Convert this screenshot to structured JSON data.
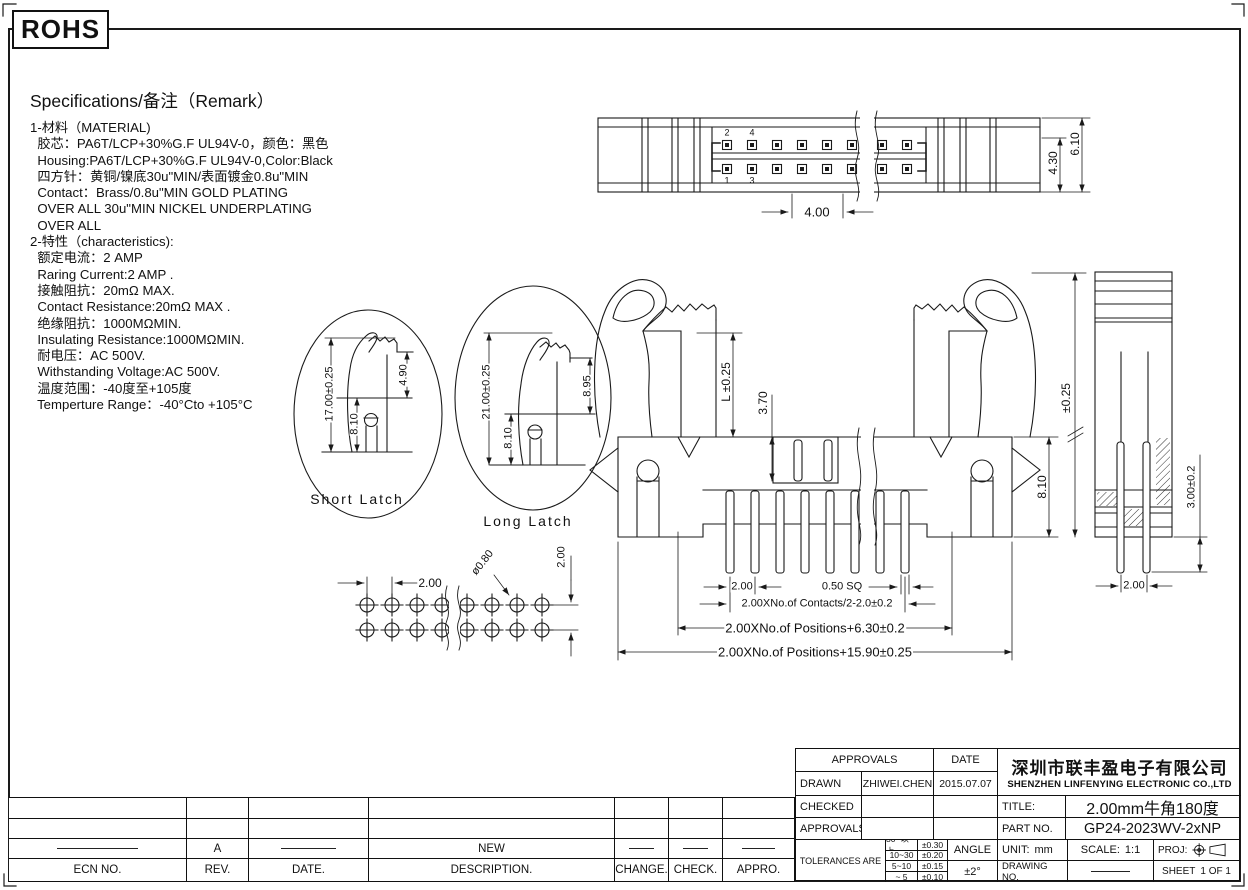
{
  "rohs_label": "ROHS",
  "specifications": {
    "title": "Specifications/备注（Remark）",
    "lines": [
      "1-材料（MATERIAL)",
      "  胶芯：PA6T/LCP+30%G.F UL94V-0，颜色：黑色",
      "  Housing:PA6T/LCP+30%G.F UL94V-0,Color:Black",
      "  四方针：黄铜/镍底30u\"MIN/表面镀金0.8u\"MIN",
      "  Contact：Brass/0.8u\"MIN GOLD PLATING",
      "  OVER ALL 30u\"MIN NICKEL UNDERPLATING",
      "  OVER ALL",
      "2-特性（characteristics):",
      "  额定电流：2 AMP",
      "  Raring Current:2 AMP .",
      "  接触阻抗：20mΩ MAX.",
      "  Contact Resistance:20mΩ MAX .",
      "  绝缘阻抗：1000MΩMIN.",
      "  Insulating Resistance:1000MΩMIN.",
      "  耐电压：AC 500V.",
      "  Withstanding Voltage:AC 500V.",
      "  温度范围：-40度至+105度",
      "  Temperture Range：-40°Cto +105°C"
    ]
  },
  "views": {
    "short_latch_label": "Short Latch",
    "long_latch_label": "Long Latch"
  },
  "pin_labels": {
    "p2": "2",
    "p4": "4",
    "p1": "1",
    "p3": "3"
  },
  "dimensions": {
    "top_view": {
      "notch": "4.00",
      "inner": "4.30",
      "overall": "6.10"
    },
    "front_view": {
      "latch_height": "L ±0.25",
      "slot_depth": "3.70",
      "body_height": "8.10",
      "pin_pitch": "2.00",
      "pin_square": "0.50 SQ",
      "contacts_span": "2.00XNo.of Contacts/2-2.0±0.2",
      "positions_span": "2.00XNo.of Positions+6.30±0.2",
      "overall_span": "2.00XNo.of Positions+15.90±0.25"
    },
    "side_view": {
      "height_tol": "±0.25",
      "tail_length": "3.00±0.2",
      "pin_pitch": "2.00"
    },
    "short_latch": {
      "overall": "17.00±0.25",
      "body": "8.10",
      "tip": "4.90"
    },
    "long_latch": {
      "overall": "21.00±0.25",
      "body": "8.10",
      "tip": "8.95"
    },
    "footprint": {
      "pitch": "2.00",
      "hole_dia": "ø0.80",
      "row_pitch": "2.00"
    }
  },
  "title_block": {
    "approvals_header": "APPROVALS",
    "date_header": "DATE",
    "rows": [
      {
        "label": "DRAWN",
        "name": "ZHIWEI.CHEN",
        "date": "2015.07.07"
      },
      {
        "label": "CHECKED",
        "name": "",
        "date": ""
      },
      {
        "label": "APPROVALS",
        "name": "",
        "date": ""
      }
    ],
    "tolerances_label": "TOLERANCES ARE",
    "tolerance_ranges": [
      "30~以上",
      "10~30",
      "5~10",
      "~ 5"
    ],
    "tolerance_values": [
      "±0.30",
      "±0.20",
      "±0.15",
      "±0.10"
    ],
    "angle_label": "ANGLE",
    "angle_value": "±2°",
    "company_cn": "深圳市联丰盈电子有限公司",
    "company_en": "SHENZHEN LINFENYING ELECTRONIC CO.,LTD",
    "title_label": "TITLE:",
    "title_value": "2.00mm牛角180度",
    "part_label": "PART NO.",
    "part_value": "GP24-2023WV-2xNP",
    "unit_label": "UNIT:",
    "unit_value": "mm",
    "scale_label": "SCALE:",
    "scale_value": "1:1",
    "proj_label": "PROJ:",
    "drawing_no_label": "DRAWING NO.",
    "sheet_label": "SHEET",
    "sheet_value": "1 OF 1"
  },
  "revision_table": {
    "headers": [
      "ECN NO.",
      "REV.",
      "DATE.",
      "DESCRIPTION.",
      "CHANGE.",
      "CHECK.",
      "APPRO."
    ],
    "entry": {
      "rev": "A",
      "description": "NEW"
    }
  }
}
